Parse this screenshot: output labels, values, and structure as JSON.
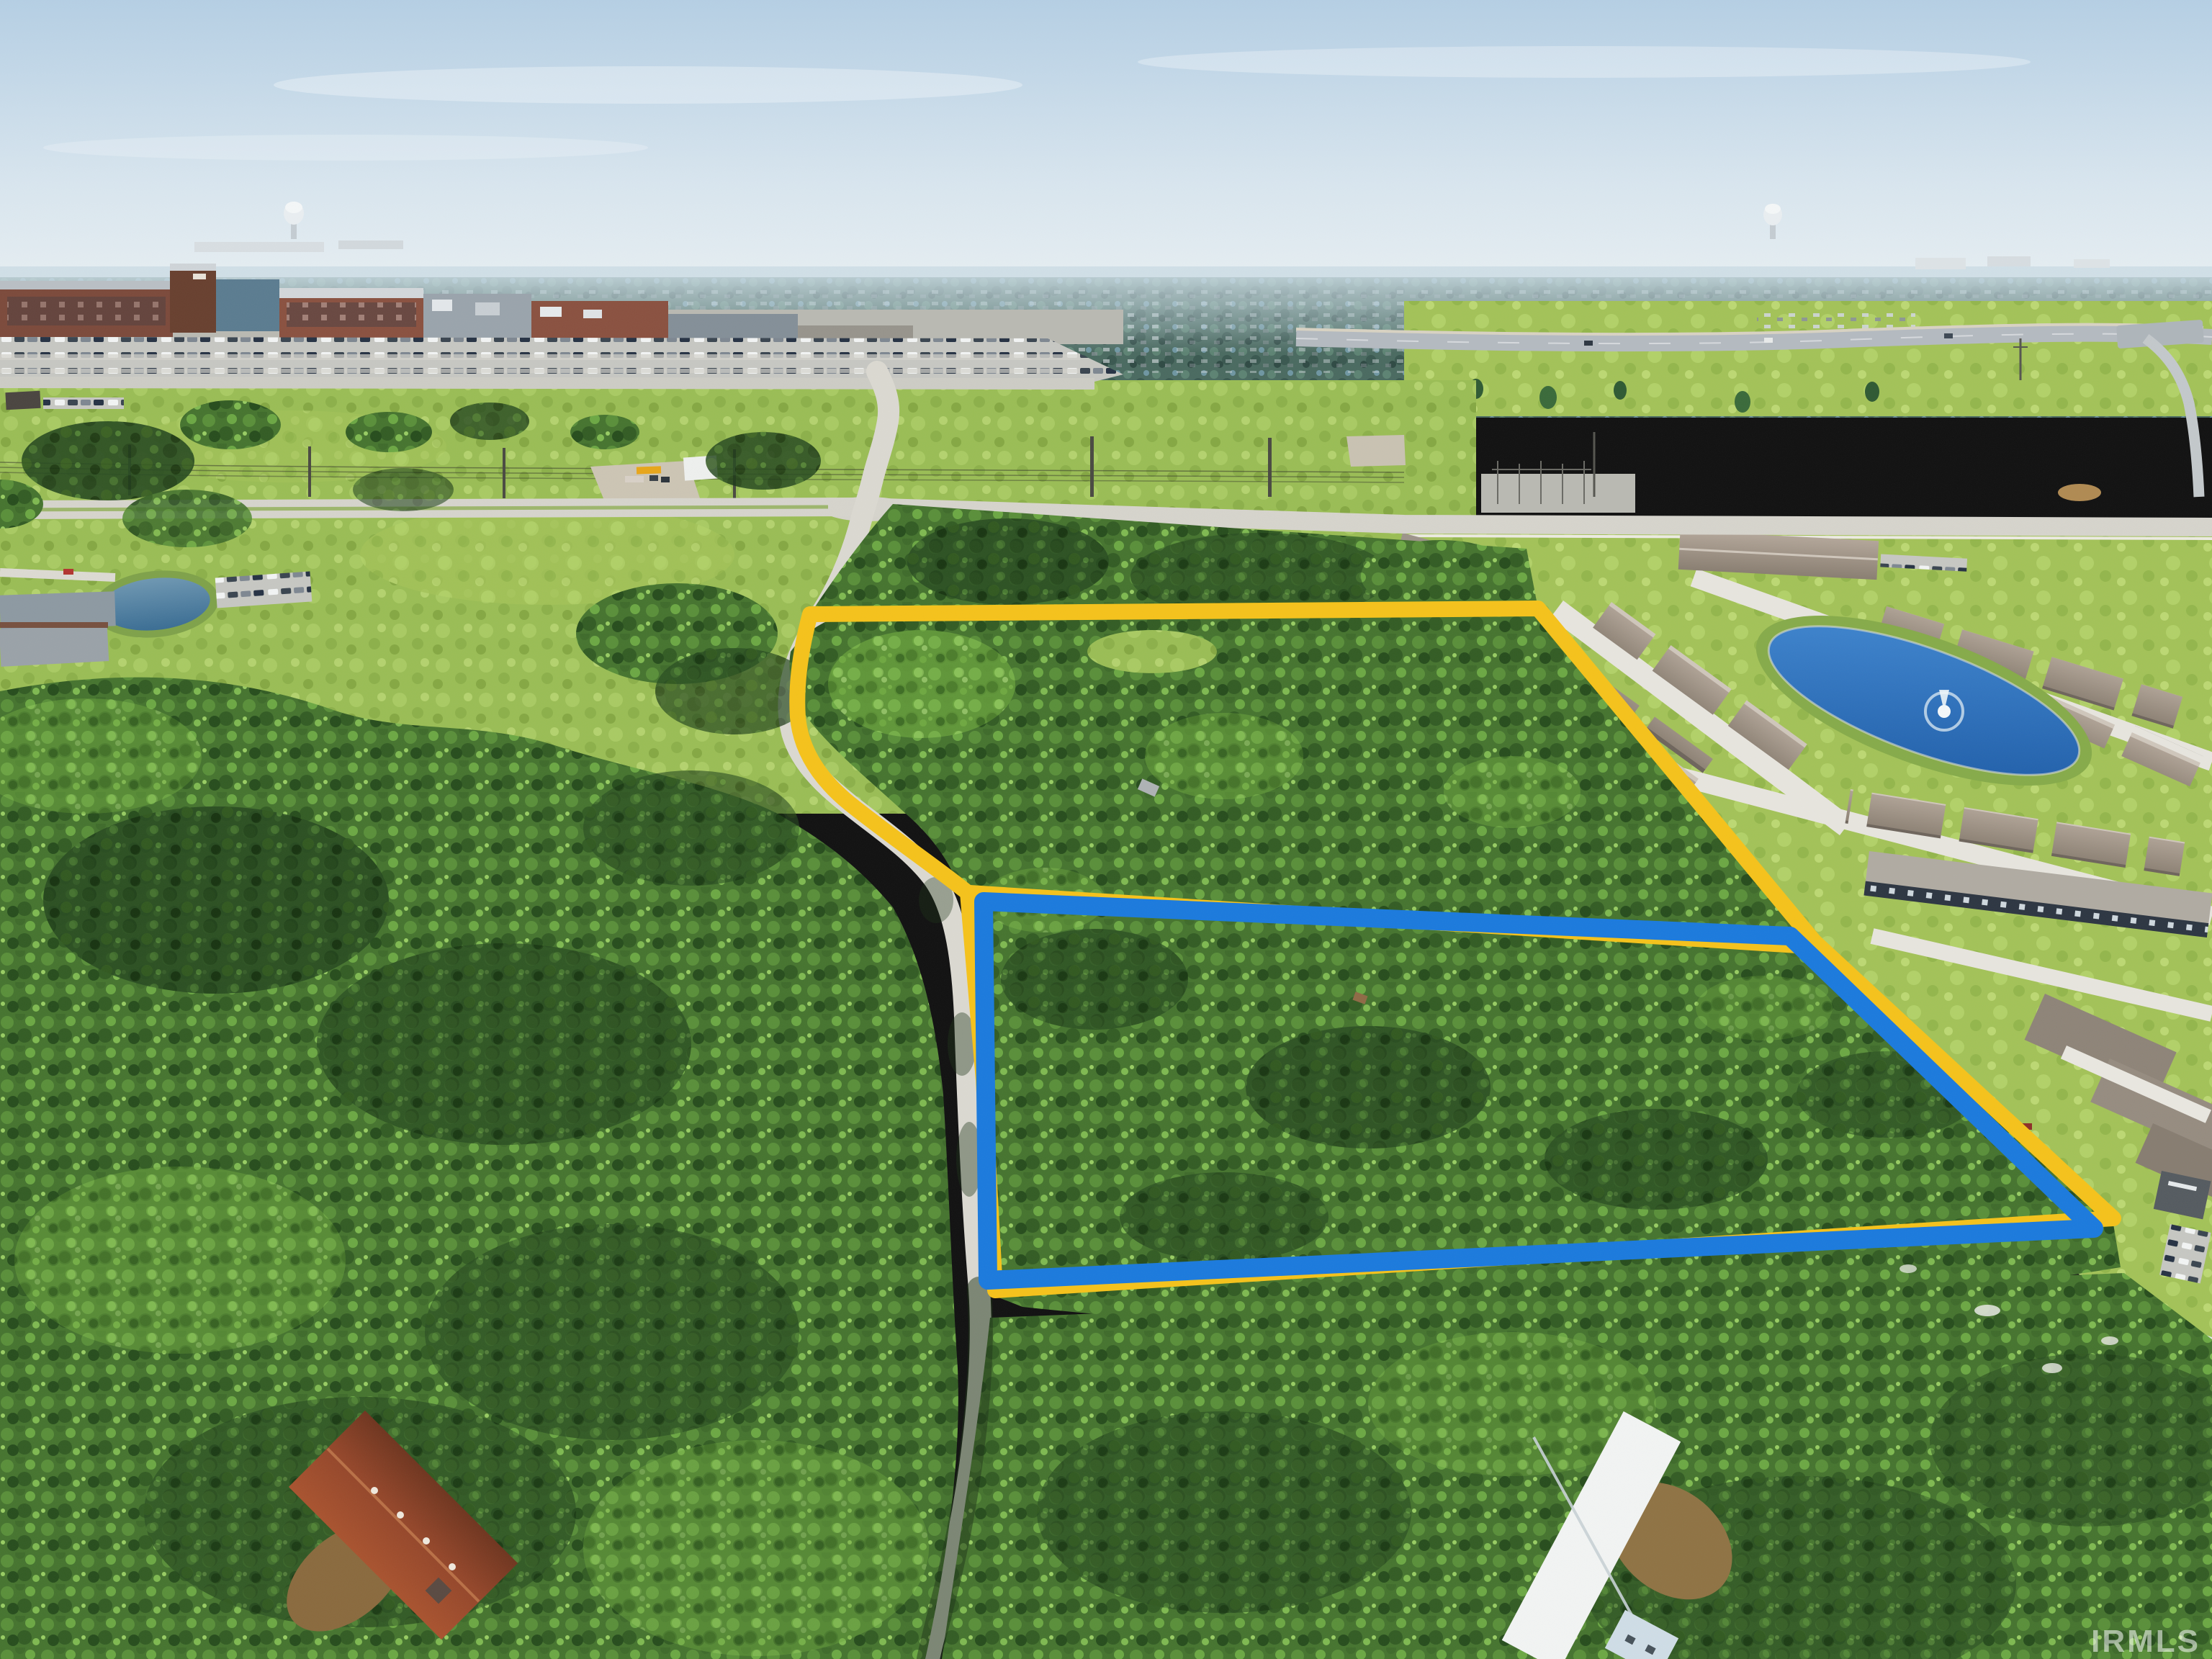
{
  "watermark": {
    "text": "IRMLS",
    "color": "rgba(255,255,255,0.55)"
  },
  "overlays": {
    "property_outline": {
      "color": "#F5C21B",
      "stroke_width": 22,
      "description": "Yellow boundary around the entire wooded property, following the gravel road on the west, with an internal division line between upper and lower parcels"
    },
    "lower_parcel_outline": {
      "color": "#1B7ADD",
      "stroke_width": 26,
      "description": "Blue boundary around the lower (southern) wooded parcel"
    }
  },
  "scene": {
    "type": "aerial-photograph",
    "description": "Drone aerial photo of two adjoining wooded land parcels outlined in yellow and blue, bordered by a gravel road to the west, a villa development with a fountain pond to the east, a hospital campus and highway to the north, and dense forest to the south",
    "palette": {
      "sky_top": "#b5cfe4",
      "sky_horizon": "#edf2f3",
      "far_forest": "#46695c",
      "field_green": "#9abd55",
      "canopy_green": "#46742f",
      "canopy_dark": "#274a20",
      "canopy_light": "#69a23c",
      "road_concrete": "#d6d4cc",
      "parking_gray": "#c8c9c4",
      "hospital_brick": "#8a5140",
      "pond_blue": "#2e74c0",
      "development_roof": "#a79d90",
      "street_white": "#e7e5de",
      "farmhouse_roof": "#9c4a2c",
      "barn_roof": "#f2f4f3"
    },
    "landmarks": [
      {
        "id": "hospital-campus",
        "label": "Brick hospital / medical campus"
      },
      {
        "id": "hospital-parking",
        "label": "Large visitor parking lot full of cars"
      },
      {
        "id": "highway",
        "label": "Highway with sound wall and overpass"
      },
      {
        "id": "water-tower-west",
        "label": "Water tower on west horizon"
      },
      {
        "id": "water-tower-east",
        "label": "Water tower on east horizon"
      },
      {
        "id": "open-field",
        "label": "Open grassland with scattered trees"
      },
      {
        "id": "power-line-corridor",
        "label": "Power line corridor with poles"
      },
      {
        "id": "substation",
        "label": "Electrical substation"
      },
      {
        "id": "bus-lot",
        "label": "Gravel lot with school bus and small white building"
      },
      {
        "id": "country-road",
        "label": "Gravel road running south past the parcels"
      },
      {
        "id": "townhome-development",
        "label": "Villa development with white streets"
      },
      {
        "id": "retention-pond",
        "label": "Blue retention pond with fountain"
      },
      {
        "id": "upper-parcel",
        "label": "Upper wooded parcel outlined in yellow"
      },
      {
        "id": "lower-parcel",
        "label": "Lower wooded parcel outlined in blue"
      },
      {
        "id": "west-forest",
        "label": "Dense forest west of the road"
      },
      {
        "id": "south-forest",
        "label": "Dense forest along bottom of frame"
      },
      {
        "id": "farmhouse",
        "label": "Rust-roofed house hidden in trees"
      },
      {
        "id": "barn",
        "label": "White metal-roofed outbuilding"
      },
      {
        "id": "office-pond",
        "label": "Small office pond with parking"
      }
    ]
  }
}
